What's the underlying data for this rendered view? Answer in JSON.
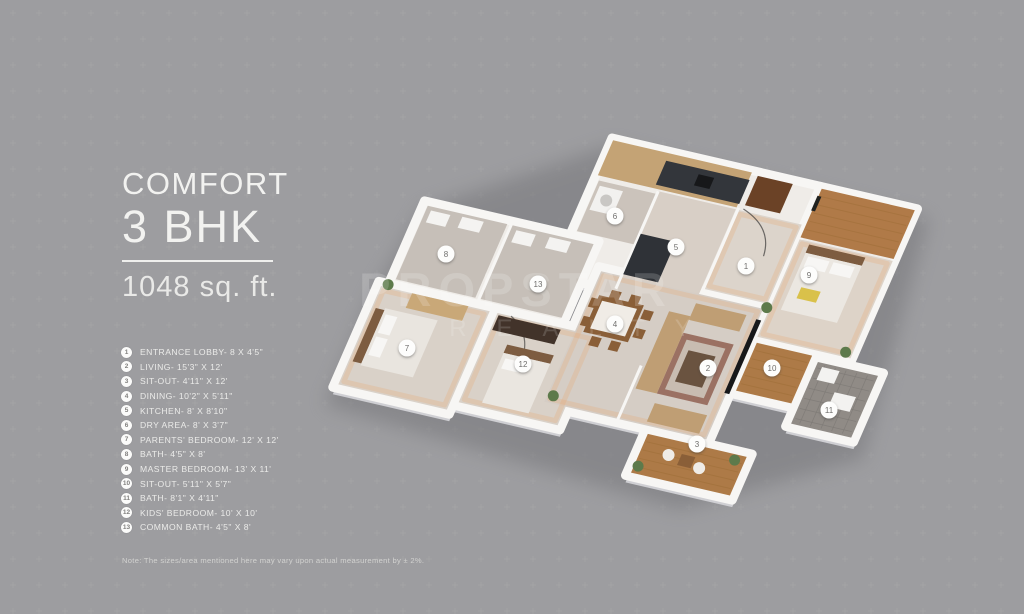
{
  "title": {
    "line1": "COMFORT",
    "line2": "3 BHK",
    "area": "1048 sq. ft."
  },
  "watermark": {
    "line1": "PROPSTAR",
    "line2": "REALTY"
  },
  "legend": [
    {
      "num": "1",
      "label": "ENTRANCE LOBBY- 8 X 4'5\""
    },
    {
      "num": "2",
      "label": "LIVING- 15'3\" X 12'"
    },
    {
      "num": "3",
      "label": "SIT-OUT- 4'11\" X 12'"
    },
    {
      "num": "4",
      "label": "DINING- 10'2\" X 5'11\""
    },
    {
      "num": "5",
      "label": "KITCHEN- 8' X 8'10\""
    },
    {
      "num": "6",
      "label": "DRY AREA- 8' X 3'7\""
    },
    {
      "num": "7",
      "label": "PARENTS' BEDROOM- 12' X 12'"
    },
    {
      "num": "8",
      "label": "BATH- 4'5\" X 8'"
    },
    {
      "num": "9",
      "label": "MASTER BEDROOM- 13' X 11'"
    },
    {
      "num": "10",
      "label": "SIT-OUT- 5'11\" X 5'7\""
    },
    {
      "num": "11",
      "label": "BATH- 8'1\" X 4'11\""
    },
    {
      "num": "12",
      "label": "KIDS' BEDROOM- 10' X 10'"
    },
    {
      "num": "13",
      "label": "COMMON BATH- 4'5\" X 8'"
    }
  ],
  "note": "Note: The sizes/area mentioned here may vary upon actual measurement by ± 2%.",
  "plan_markers": [
    {
      "num": "1",
      "x": 746,
      "y": 266
    },
    {
      "num": "2",
      "x": 708,
      "y": 368
    },
    {
      "num": "3",
      "x": 697,
      "y": 444
    },
    {
      "num": "4",
      "x": 615,
      "y": 324
    },
    {
      "num": "5",
      "x": 676,
      "y": 247
    },
    {
      "num": "6",
      "x": 615,
      "y": 216
    },
    {
      "num": "7",
      "x": 407,
      "y": 348
    },
    {
      "num": "8",
      "x": 446,
      "y": 254
    },
    {
      "num": "9",
      "x": 809,
      "y": 275
    },
    {
      "num": "10",
      "x": 772,
      "y": 368
    },
    {
      "num": "11",
      "x": 829,
      "y": 410
    },
    {
      "num": "12",
      "x": 523,
      "y": 364
    },
    {
      "num": "13",
      "x": 538,
      "y": 284
    }
  ],
  "colors": {
    "background": "#9d9da0",
    "title_text": "#f2f2f0",
    "marker_bg": "#fdfdfc",
    "marker_text": "#6f6e6c",
    "wall": "#f7f6f4",
    "wood_floor": "#ad7a47",
    "tile_floor": "#908b86",
    "counter_dark": "#33363b",
    "cabinet_tan": "#c4a375",
    "watermark": "#ffffff"
  }
}
